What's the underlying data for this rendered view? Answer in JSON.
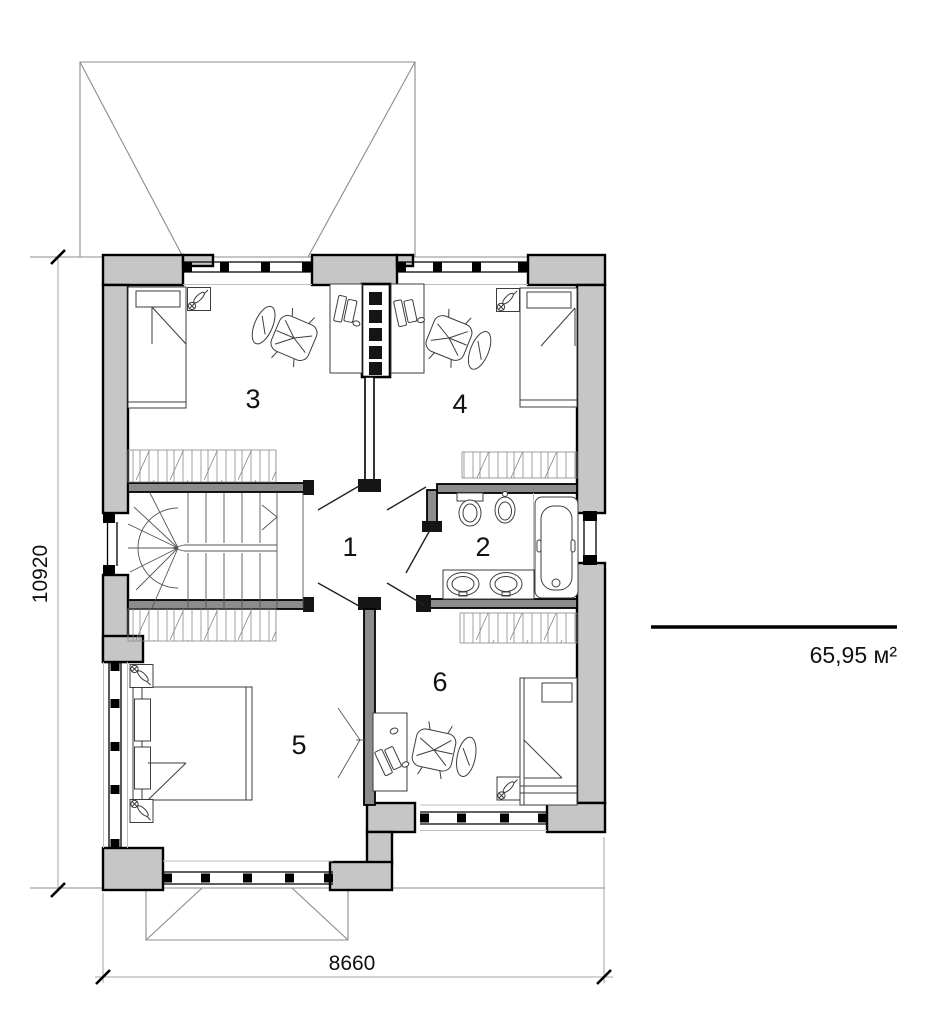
{
  "drawing": {
    "type": "floor-plan",
    "room_labels": [
      "1",
      "2",
      "3",
      "4",
      "5",
      "6"
    ],
    "dimensions": {
      "vertical": "10920",
      "horizontal": "8660"
    },
    "area_label": "65,95 м²",
    "colors": {
      "exterior_wall_fill": "#c6c6c6",
      "interior_wall_fill": "#8c8c8c",
      "outline": "#000000",
      "furniture_line": "#3d3d3d",
      "roof_line": "#8c8c8c",
      "dimension_line": "#a6a6a6"
    },
    "icons": [
      "single-bed-icon",
      "double-bed-icon",
      "office-chair-icon",
      "desk-icon",
      "laptop-icon",
      "plant-icon",
      "toilet-icon",
      "bidet-icon",
      "bathtub-icon",
      "double-sink-vanity-icon",
      "stairs-icon",
      "door-leaf-icon",
      "window-icon",
      "chimney-shaft-icon",
      "roof-outline-icon",
      "low-ceiling-hatch-icon"
    ]
  }
}
